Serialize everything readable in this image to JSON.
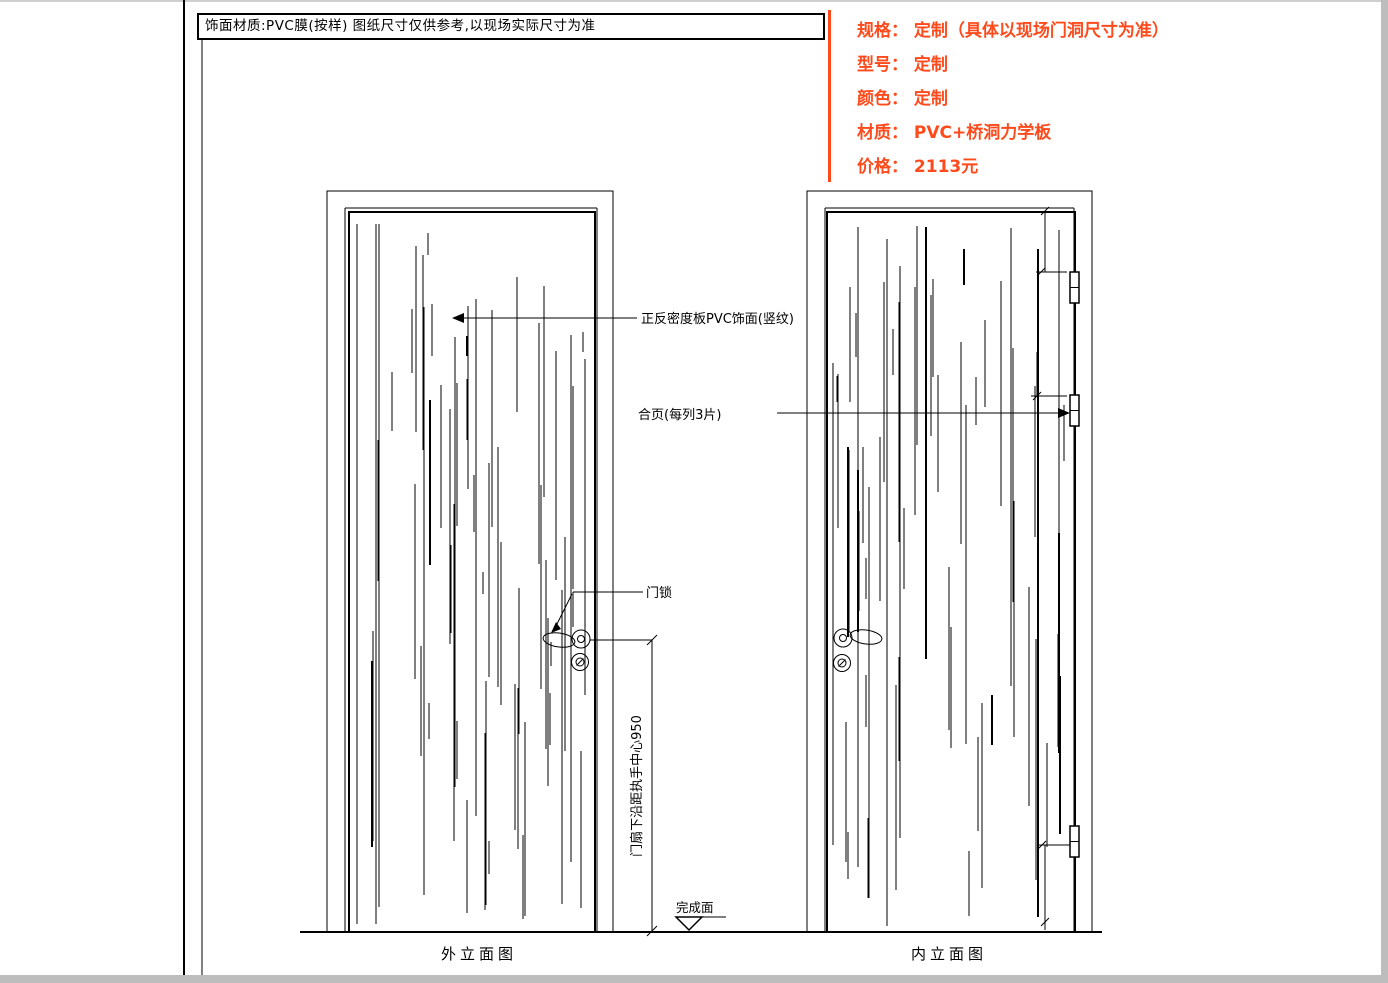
{
  "title_bar": {
    "text": "饰面材质:PVC膜(按样)  图纸尺寸仅供参考,以现场实际尺寸为准"
  },
  "specs": {
    "accent_color": "#ff4a1c",
    "lines": [
      "规格： 定制（具体以现场门洞尺寸为准）",
      "型号： 定制",
      "颜色： 定制",
      "材质： PVC+桥洞力学板",
      "价格： 2113元"
    ]
  },
  "drawing": {
    "annotations": {
      "surface_note": "正反密度板PVC饰面(竖纹)",
      "hinge_note": "合页(每列3片)",
      "lock_note": "门锁",
      "handle_height_dim": "门扇下沿距执手中心950",
      "finish_level": "完成面"
    },
    "captions": {
      "left_view": "外立面图",
      "right_view": "内立面图"
    }
  }
}
